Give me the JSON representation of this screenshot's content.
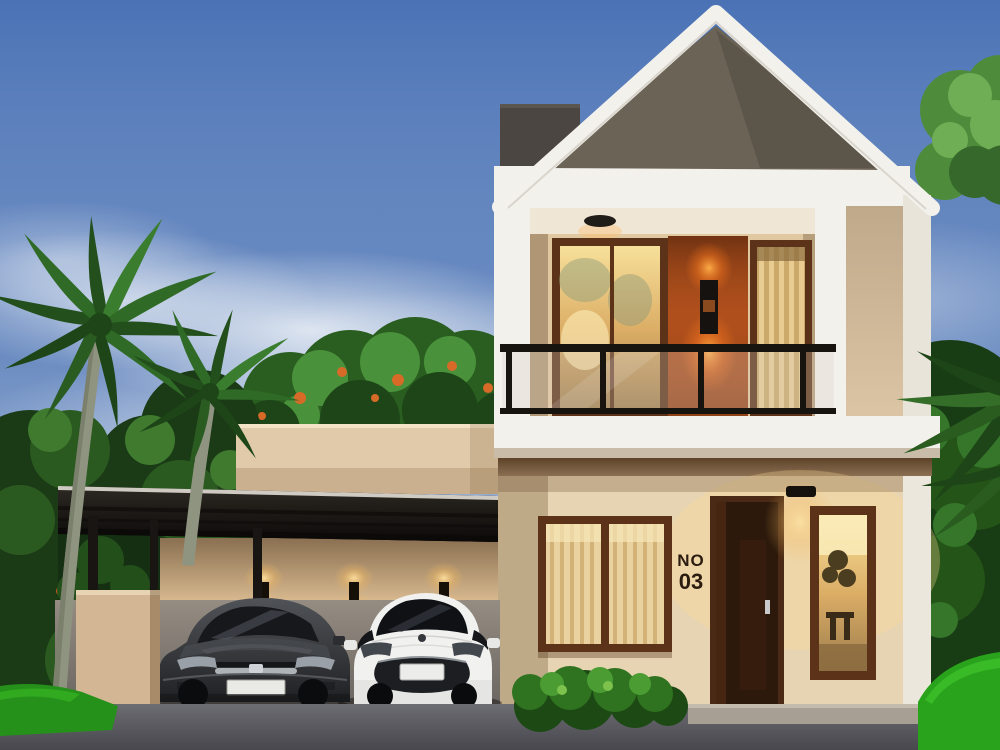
{
  "scene": {
    "house_number": {
      "line1": "NO",
      "line2": "03"
    }
  },
  "palette": {
    "sky_blue": "#4a72b5",
    "roof_gable_gray": "#6b6355",
    "trim_white": "#f3f1ec",
    "wall_cream": "#e7d4b2",
    "side_wall_cream": "#dbc5a4",
    "accent_orange": "#a84c1c",
    "frame_brown": "#5c3318",
    "door_brown": "#2c190b",
    "warm_light": "#f6dd96",
    "canopy_black": "#1b1714",
    "foliage_green": "#1d4517",
    "grass_green": "#2aa31c",
    "road_gray": "#5d5d64",
    "car_dark": "#3b3d40",
    "car_white": "#f1f1ef"
  }
}
